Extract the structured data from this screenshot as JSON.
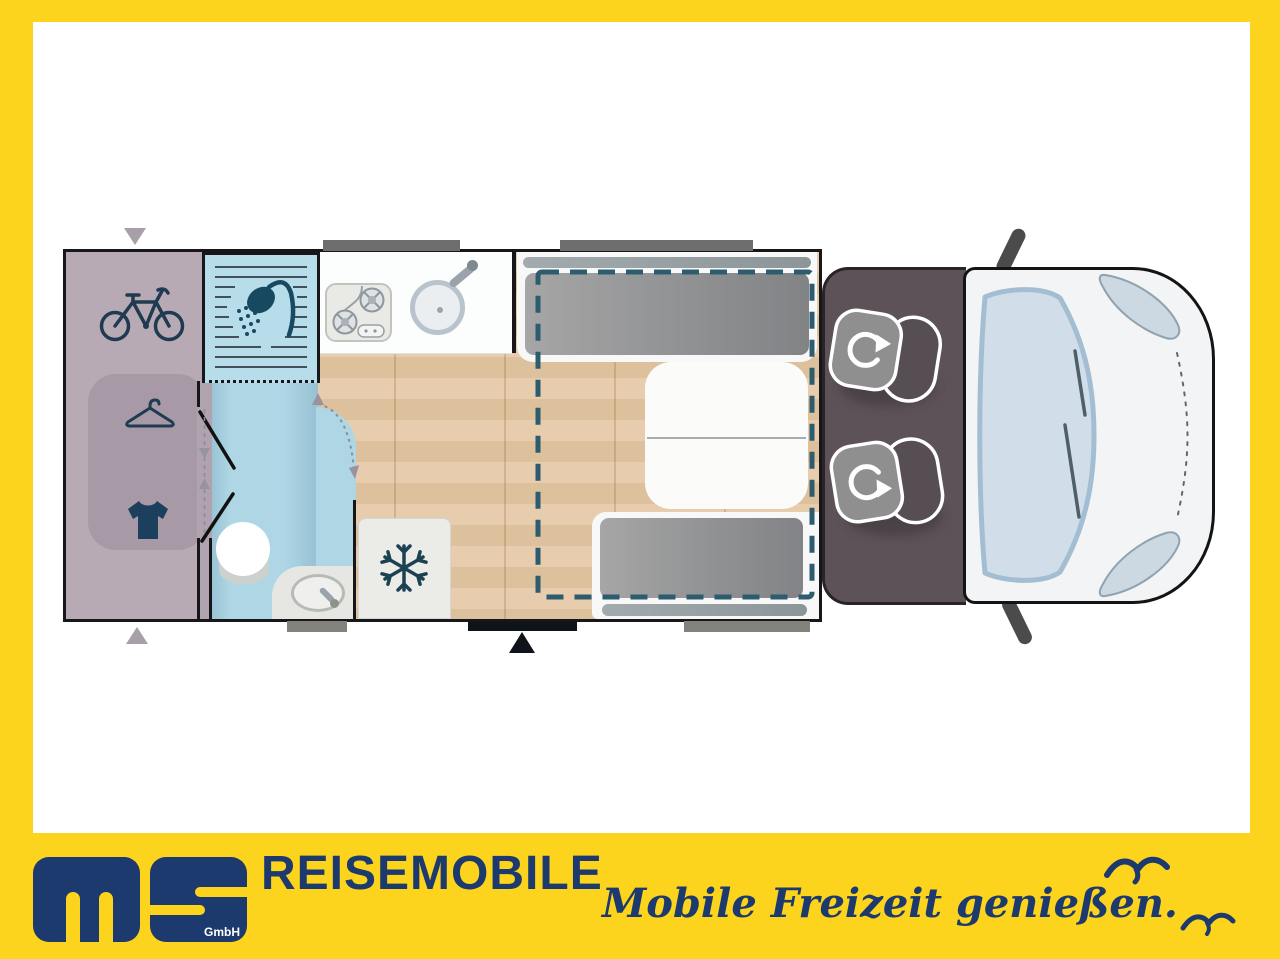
{
  "branding": {
    "wordmark": "REISEMOBILE",
    "logo_monogram_letters": "ms",
    "logo_suffix": "GmbH",
    "tagline": "Mobile Freizeit genießen.",
    "colors": {
      "accent_yellow": "#fcd31d",
      "brand_navy": "#1c3a6d"
    }
  },
  "floorplan": {
    "view": "motorhome top view",
    "areas": [
      {
        "id": "rear-garage",
        "features": [
          "bicycle storage",
          "wardrobe",
          "clothing storage"
        ]
      },
      {
        "id": "shower-cubicle",
        "features": [
          "shower"
        ]
      },
      {
        "id": "bathroom",
        "features": [
          "toilet",
          "washbasin"
        ]
      },
      {
        "id": "kitchen",
        "features": [
          "two-burner stove",
          "round sink"
        ]
      },
      {
        "id": "refrigerator",
        "features": [
          "fridge-freezer"
        ]
      },
      {
        "id": "dinette",
        "features": [
          "facing bench seats",
          "folding table",
          "drop-down bed outline"
        ]
      },
      {
        "id": "driver-cab",
        "features": [
          "swivel driver seat",
          "swivel passenger seat"
        ]
      },
      {
        "id": "vehicle-front",
        "features": [
          "windshield",
          "wipers",
          "headlights",
          "side mirrors"
        ]
      }
    ],
    "markers": {
      "entrance": "black door bar with arrow at bottom center",
      "rear_hatch_arrows": 2,
      "window_count": 4
    },
    "colors": {
      "garage": "#b8aab5",
      "wardrobe": "#a79aa6",
      "wet_room": "#aed6e5",
      "wood_floor": "#e5c9a8",
      "seat_gray": "#9c9c9c",
      "cab_floor": "#5c5258",
      "bed_outline_teal": "#2d5c6e",
      "window_gray": "#6e6e6e",
      "door_black": "#0f141b",
      "van_body": "#f2f4f5",
      "windshield": "#d1dee9",
      "icon_navy": "#1c3f5b"
    }
  }
}
